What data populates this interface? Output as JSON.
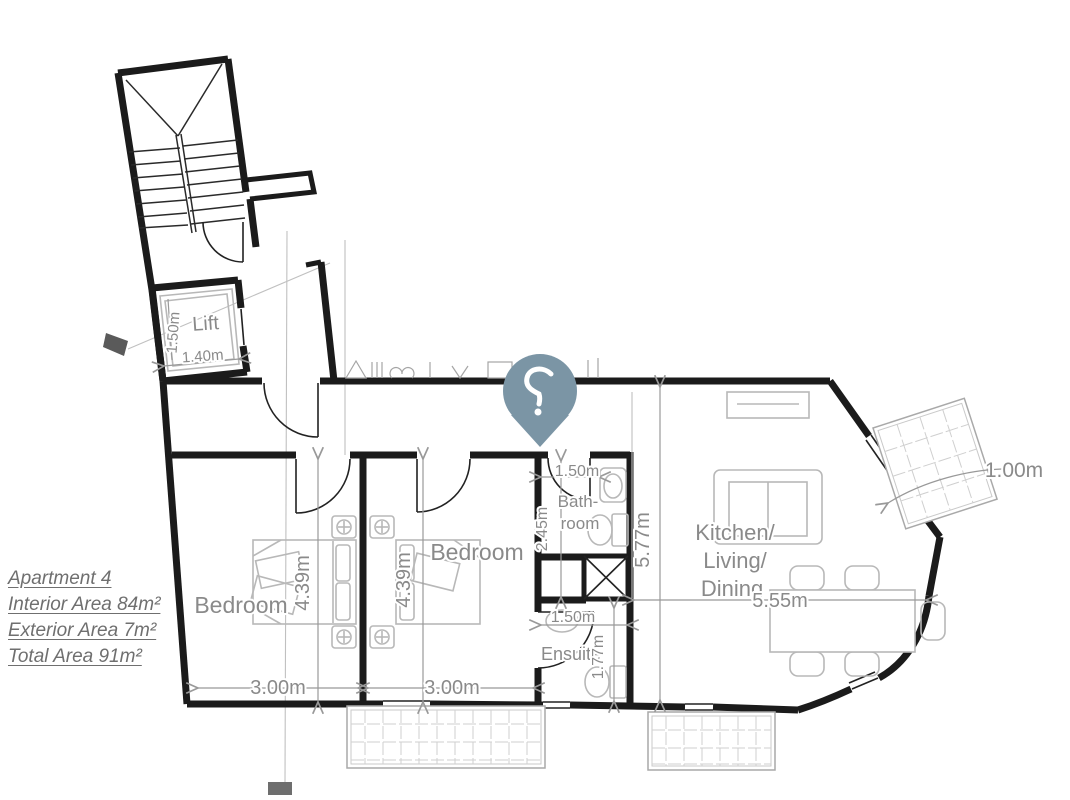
{
  "info": {
    "title": "Apartment 4",
    "interior": "Interior Area 84m²",
    "exterior": "Exterior Area 7m²",
    "total": "Total Area 91m²"
  },
  "rooms": {
    "lift": "Lift",
    "bedroom1": "Bedroom",
    "bedroom2": "Bedroom",
    "bathroom": [
      "Bath-",
      "room"
    ],
    "ensuite": "Ensuite",
    "kitchen": [
      "Kitchen/",
      "Living/",
      "Dining"
    ]
  },
  "dims": {
    "lift_width": "1.40m",
    "lift_depth": "1.50m",
    "bedroom1_width": "3.00m",
    "bedroom1_depth": "4.39m",
    "bedroom2_width": "3.00m",
    "bedroom2_depth": "4.39m",
    "bathroom_width": "1.50m",
    "bathroom_depth": "2.45m",
    "ensuite_width": "1.50m",
    "ensuite_depth": "1.77m",
    "kitchen_width": "5.55m",
    "kitchen_depth": "5.77m",
    "balcony_width": "1.00m"
  },
  "colors": {
    "pin": "#7B95A5",
    "wall": "#1B1B1B",
    "fixture": "#B8B8B8",
    "dimension": "#8A8A8A",
    "info_text": "#6F6F6F"
  }
}
